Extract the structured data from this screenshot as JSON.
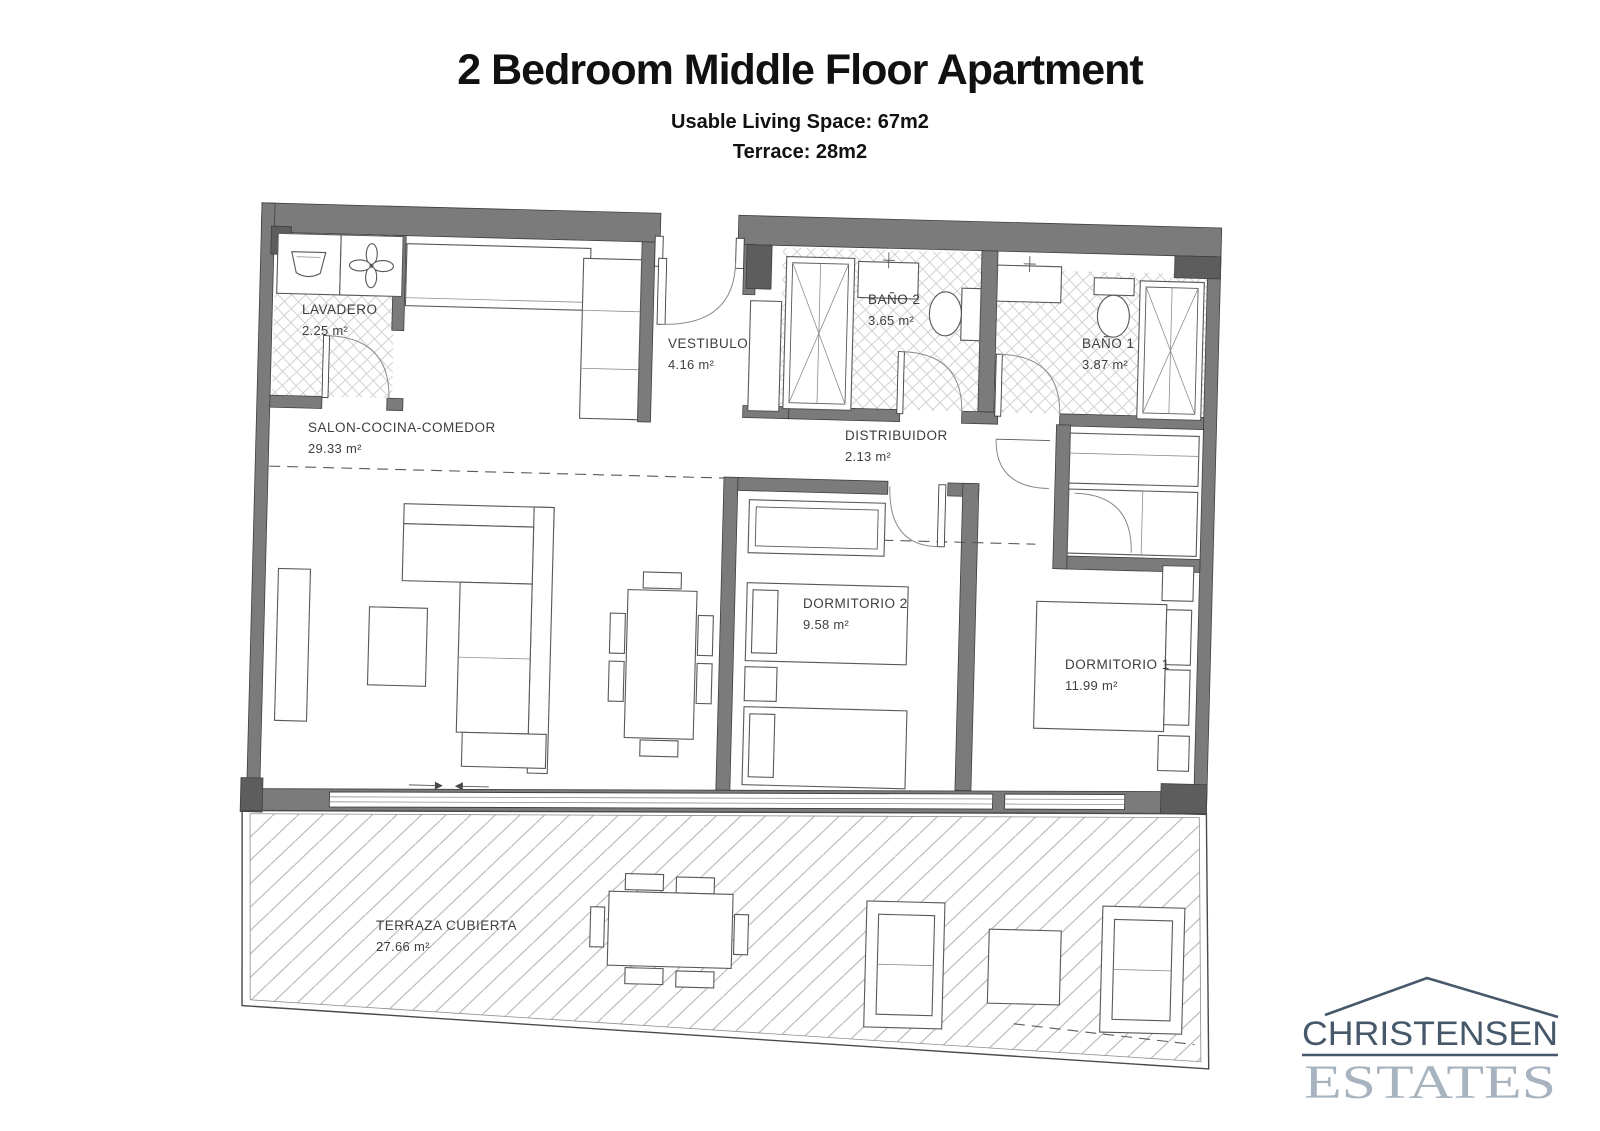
{
  "header": {
    "title": "2 Bedroom Middle Floor Apartment",
    "subtitle_living": "Usable Living Space: 67m2",
    "subtitle_terrace": "Terrace: 28m2"
  },
  "rooms": [
    {
      "id": "lavadero",
      "name": "LAVADERO",
      "area": "2.25 m²"
    },
    {
      "id": "salon",
      "name": "SALON-COCINA-COMEDOR",
      "area": "29.33 m²"
    },
    {
      "id": "vestibulo",
      "name": "VESTIBULO",
      "area": "4.16 m²"
    },
    {
      "id": "bano2",
      "name": "BAÑO 2",
      "area": "3.65 m²"
    },
    {
      "id": "bano1",
      "name": "BAÑO 1",
      "area": "3.87 m²"
    },
    {
      "id": "distribuidor",
      "name": "DISTRIBUIDOR",
      "area": "2.13 m²"
    },
    {
      "id": "dormitorio2",
      "name": "DORMITORIO 2",
      "area": "9.58 m²"
    },
    {
      "id": "dormitorio1",
      "name": "DORMITORIO 1",
      "area": "11.99 m²"
    },
    {
      "id": "terraza",
      "name": "TERRAZA CUBIERTA",
      "area": "27.66 m²"
    }
  ],
  "logo": {
    "line1": "CHRISTENSEN",
    "line2": "ESTATES"
  },
  "colors": {
    "wall": "#7b7b7b",
    "pillar": "#5d5d5d",
    "plan_line": "#585858",
    "logo_dark": "#46586a",
    "logo_light": "#a7b3bf"
  },
  "icons": [
    "washbasin-icon",
    "fan-icon",
    "roof-icon"
  ]
}
